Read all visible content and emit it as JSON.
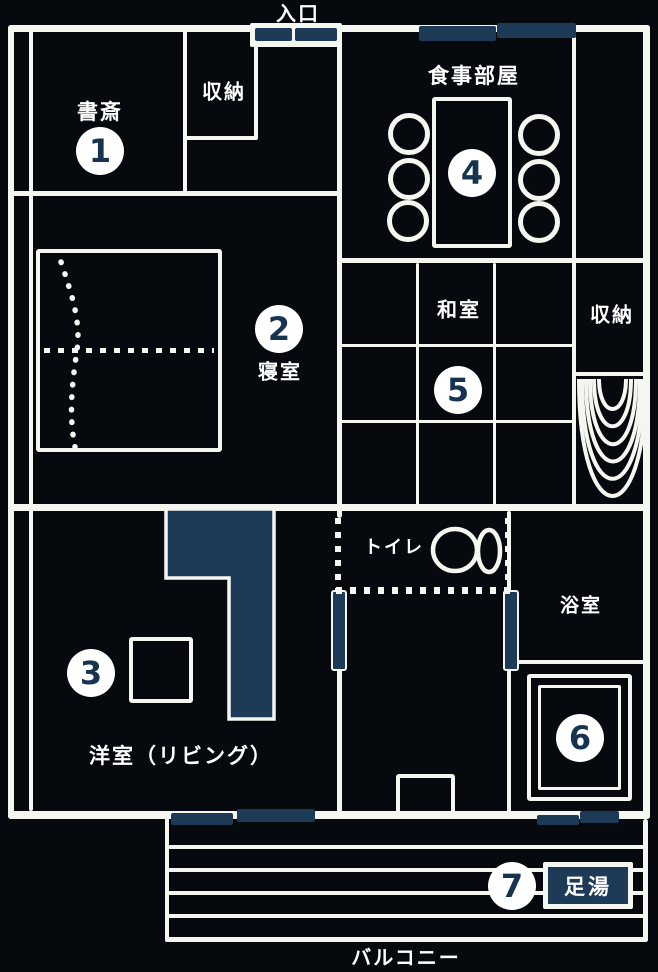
{
  "colors": {
    "background": "#060a0f",
    "wall": "#f6f6f0",
    "navy_accent": "#1d3b56",
    "number_digit": "#163450"
  },
  "entrance": {
    "label": "入口"
  },
  "balcony": {
    "label": "バルコニー"
  },
  "rooms": {
    "study": {
      "label": "書斎",
      "number": "1"
    },
    "storage_top": {
      "label": "収納"
    },
    "dining": {
      "label": "食事部屋",
      "number": "4"
    },
    "bedroom": {
      "label": "寝室",
      "number": "2"
    },
    "japanese_room": {
      "label": "和室",
      "number": "5"
    },
    "storage_right": {
      "label": "収納"
    },
    "living": {
      "label": "洋室（リビング）",
      "number": "3"
    },
    "toilet": {
      "label": "トイレ"
    },
    "bathroom": {
      "label": "浴室",
      "number": "6"
    },
    "foot_bath": {
      "label": "足湯",
      "number": "7"
    }
  }
}
